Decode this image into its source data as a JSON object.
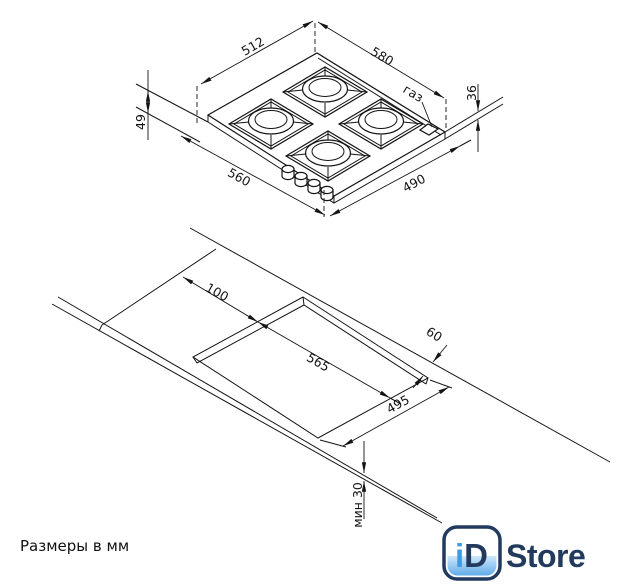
{
  "caption": "Размеры в мм",
  "hob_view": {
    "dim_back_left": "512",
    "dim_back_right": "580",
    "dim_front_left": "560",
    "dim_front_right": "490",
    "dim_height_left": "49",
    "dim_height_right": "36",
    "gas_label": "газ"
  },
  "cutout_view": {
    "dim_side_clearance": "100",
    "dim_cutout_width": "565",
    "dim_cutout_depth": "495",
    "dim_back_clearance": "60",
    "dim_front_min": "мин 30"
  },
  "logo": {
    "badge_i": "i",
    "badge_d": "D",
    "wordmark": "Store",
    "navy": "#223a5e",
    "blue": "#3e9bdf"
  },
  "colors": {
    "line": "#141414",
    "background": "#ffffff"
  }
}
